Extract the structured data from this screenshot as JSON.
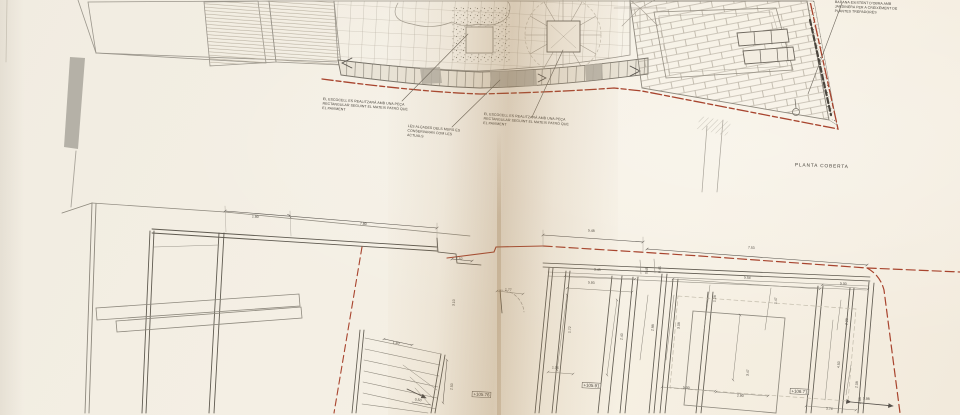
{
  "sheet": {
    "top_plan": {
      "label": "PLANTA COBERTA",
      "notes": [
        {
          "id": "escocell-left",
          "text": "EL ESCOCELL ES REALITZARÀ AMB UNA PEÇA RECTANGULAR SEGUINT EL MATEIX PATRÓ QUE EL PAVIMENT"
        },
        {
          "id": "altures-murs",
          "text": "LES ALÇADES DELS MURS ES CONSERVARAN COM LES ACTUALS"
        },
        {
          "id": "escocell-right",
          "text": "EL ESCOCELL ES REALITZARÀ AMB UNA PEÇA RECTANGULAR SEGUINT EL MATEIX PATRÓ QUE EL PAVIMENT"
        },
        {
          "id": "jardinera",
          "text": "BARANA EXISTENT D'OBRA AMB JARDINERA PER A CREIXEMENT DE PLANTES TREPADORES"
        }
      ]
    },
    "bottom_plan": {
      "levels": [
        "+105.76",
        "+105.91",
        "+106.71"
      ],
      "dimensions": [
        {
          "v": "1.80",
          "x": 252,
          "y": 215,
          "r": 4
        },
        {
          "v": "7.80",
          "x": 360,
          "y": 222,
          "r": 4
        },
        {
          "v": "1.52",
          "x": 456,
          "y": 257,
          "r": 4
        },
        {
          "v": "5.48",
          "x": 588,
          "y": 229,
          "r": 4
        },
        {
          "v": "7.53",
          "x": 748,
          "y": 246,
          "r": 4
        },
        {
          "v": "3.45",
          "x": 594,
          "y": 268,
          "r": 4
        },
        {
          "v": "0.45",
          "x": 645,
          "y": 274,
          "r": -86
        },
        {
          "v": "0.45",
          "x": 658,
          "y": 273,
          "r": -86
        },
        {
          "v": "5.54",
          "x": 744,
          "y": 276,
          "r": 4
        },
        {
          "v": "5.93",
          "x": 588,
          "y": 281,
          "r": 4
        },
        {
          "v": "5.00",
          "x": 840,
          "y": 282,
          "r": 4
        },
        {
          "v": "1.77",
          "x": 505,
          "y": 288,
          "r": 4
        },
        {
          "v": "1.28",
          "x": 713,
          "y": 302,
          "r": -86
        },
        {
          "v": "1.47",
          "x": 774,
          "y": 304,
          "r": -86
        },
        {
          "v": "1.72",
          "x": 568,
          "y": 333,
          "r": -86
        },
        {
          "v": "2.40",
          "x": 620,
          "y": 340,
          "r": -86
        },
        {
          "v": "2.98",
          "x": 651,
          "y": 331,
          "r": -86
        },
        {
          "v": "3.08",
          "x": 677,
          "y": 329,
          "r": -86
        },
        {
          "v": "2.28",
          "x": 845,
          "y": 325,
          "r": -86
        },
        {
          "v": "4.50",
          "x": 837,
          "y": 368,
          "r": -86
        },
        {
          "v": "2.08",
          "x": 855,
          "y": 388,
          "r": -86
        },
        {
          "v": "2.88",
          "x": 858,
          "y": 404,
          "r": -86
        },
        {
          "v": "3.47",
          "x": 746,
          "y": 376,
          "r": -86
        },
        {
          "v": "1.06",
          "x": 552,
          "y": 366,
          "r": 4
        },
        {
          "v": "5.00",
          "x": 683,
          "y": 386,
          "r": 4
        },
        {
          "v": "2.90",
          "x": 737,
          "y": 394,
          "r": 4
        },
        {
          "v": "3.74",
          "x": 826,
          "y": 407,
          "r": 4
        },
        {
          "v": "5.98",
          "x": 863,
          "y": 397,
          "r": 4
        },
        {
          "v": "1.40",
          "x": 393,
          "y": 341,
          "r": 8
        },
        {
          "v": "0.50",
          "x": 415,
          "y": 398,
          "r": 8
        },
        {
          "v": "2.50",
          "x": 450,
          "y": 390,
          "r": -86
        },
        {
          "v": "3.10",
          "x": 452,
          "y": 306,
          "r": -86
        }
      ]
    },
    "colors": {
      "boundary_red": "#a8442e",
      "paper": "#f3eee3",
      "fold_shadow": "#96703f",
      "line_gray": "#8d887d",
      "wall_dark": "#5f5a50"
    }
  }
}
